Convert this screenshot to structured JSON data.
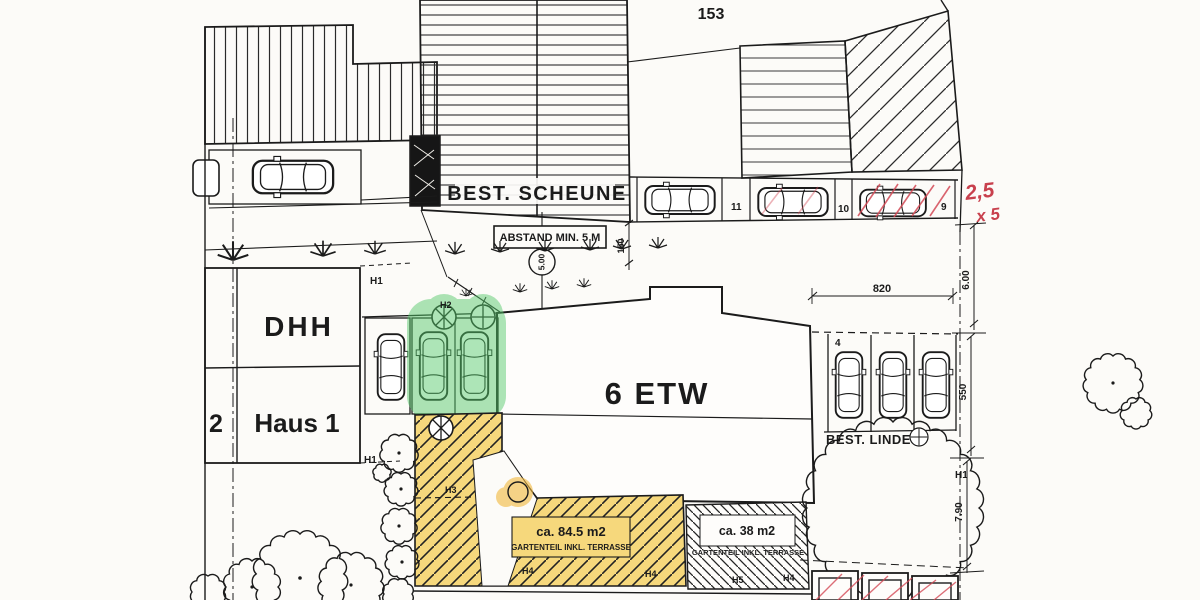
{
  "plan": {
    "plot_number": "153",
    "barn_label": "BEST. SCHEUNE",
    "main_building_label": "6 ETW",
    "dhh_label": "DHH",
    "haus_label": "Haus 1",
    "left_unit_number": "2",
    "abstand_note": "ABSTAND MIN. 5 M",
    "abstand_value": "5.00",
    "linde_label": "BEST. LINDE",
    "gardens": {
      "large": {
        "area": "ca. 84.5 m2",
        "caption": "GARTENTEIL INKL. TERRASSE"
      },
      "small": {
        "area": "ca. 38 m2",
        "caption": "GARTENTEIL INKL. TERRASSE"
      }
    },
    "dimensions": {
      "gap_820": "820",
      "right_600": "6.00",
      "right_550": "550",
      "right_790": "7.90",
      "left_150": "150"
    },
    "parking_numbers": {
      "n11": "11",
      "n10": "10",
      "n9": "9",
      "n4": "4"
    },
    "hedge_labels": {
      "h1": "H1",
      "h2": "H2",
      "h3": "H3",
      "h4": "H4",
      "h5": "H5"
    },
    "red_annotation": {
      "line1": "2,5",
      "line2": "x 5"
    },
    "colors": {
      "highlight_green": "#55c96a",
      "highlight_orange": "#f2b83c",
      "garden_yellow": "#f6d87c",
      "annotation_red": "#c8404d",
      "ink": "#1b1b1b"
    }
  }
}
